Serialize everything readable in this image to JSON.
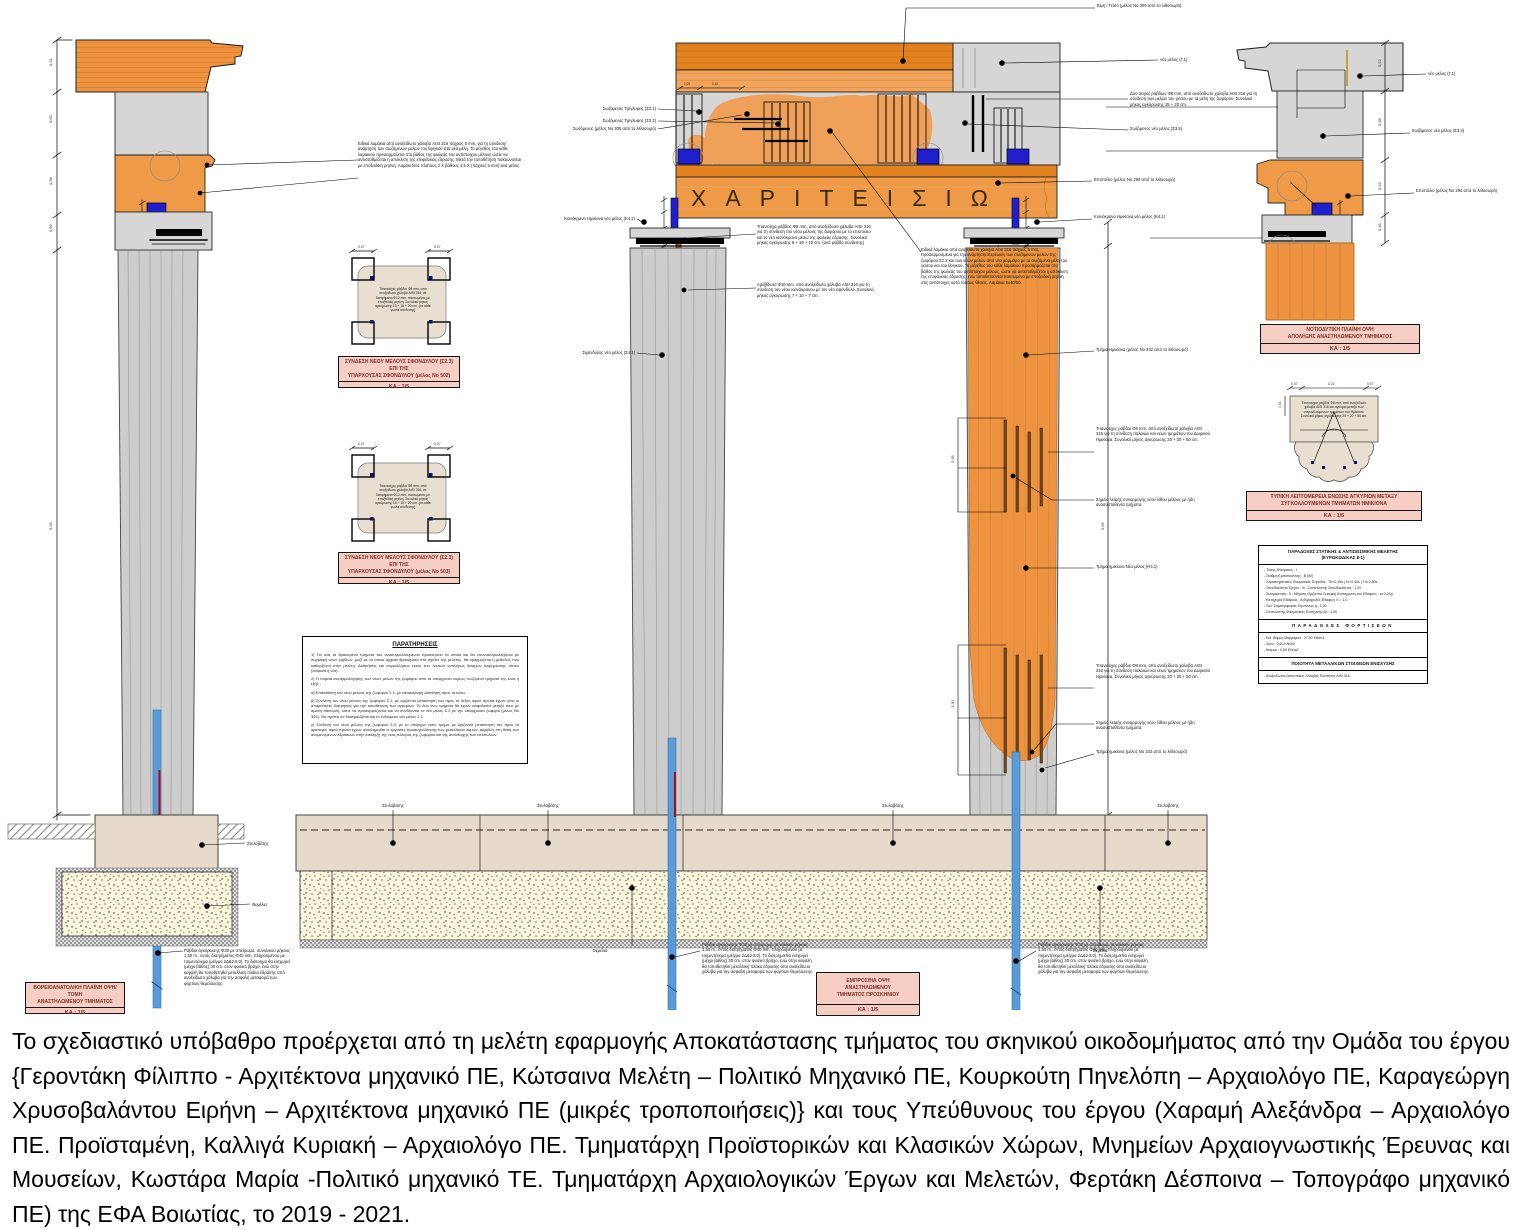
{
  "inscription": "ΧΑΡΙΤΕΙΣΙΩ",
  "label_boxes": {
    "scale": "ΚΑ : 1/5",
    "left_view": {
      "line1": "ΒΟΡΕΙΟΑΝΑΤΟΛΙΚΗ ΠΛΑΪΝΗ ΟΨΗ/ΤΟΜΗ",
      "line2": "ΑΝΑΣΤΗΛΩΜΕΝΟΥ ΤΜΗΜΑΤΟΣ"
    },
    "front_view": {
      "line1": "ΕΜΠΡΟΣΘΙΑ ΟΨΗ",
      "line2": "ΑΝΑΣΤΗΛΩΜΕΝΟΥ",
      "line3": "ΤΜΗΜΑΤΟΣ ΠΡΟΣΚΗΝΙΟΥ"
    },
    "sw_view": {
      "line1": "ΝΟΤΙΟΔΥΤΙΚΗ ΠΛΑΪΝΗ ΟΨΗ",
      "line2": "ΑΠΟΛΗΞΗΣ ΑΝΑΣΤΗΛΩΜΕΝΟΥ ΤΜΗΜΑΤΟΣ"
    },
    "detail_a": {
      "line1": "ΣΥΝΔΕΣΗ ΝΕΟΥ ΜΕΛΟΥΣ ΣΦΟΝΔΥΛΟΥ (Σ2.3) ΕΠΙ ΤΗΣ",
      "line2": "ΥΠΑΡΧΟΥΣΑΣ ΣΦΟΝΔΥΛΟΥ (μέλος Νο 502)"
    },
    "detail_b": {
      "line1": "ΣΥΝΔΕΣΗ ΝΕΟΥ ΜΕΛΟΥΣ ΣΦΟΝΔΥΛΟΥ (Σ2.3) ΕΠΙ ΤΗΣ",
      "line2": "ΥΠΑΡΧΟΥΣΑΣ ΣΦΟΝΔΥΛΟΥ (μέλος Νο 503)"
    },
    "detail_c": {
      "line1": "ΤΥΠΙΚΗ ΛΕΠΤΟΜΕΡΕΙΑ ΕΝΩΣΗΣ ΑΓΚΥΡΙΩΝ ΜΕΤΑΞΥ",
      "line2": "ΣΥΓΚΟΛΛΟΥΜΕΝΩΝ ΤΜΗΜΑΤΩΝ ΗΜΙΚΙΟΝΑ"
    }
  },
  "notes": {
    "title": "ΠΑΡΑΤΗΡΗΣΕΙΣ",
    "p1": "1) Για όλα τα θραυσμένα τμήματα του ανασυγκολλούμενου προσκηνίου τα οποία και θα επανασυγκολληθούν με συρραφή νέων ράβδων, μαζί με τα όποια αρχαία θραύσματα στα σχέδια της μελέτης, θα εφαρμόζεται η μέθοδος που καθορίζεται στην μελέτη. Διατρήσεις και συγκολλήσεις εκτός των λοιπών αναλόγως δοκιμών τεκμηρίωσης τόπου (λείψανα ή νέα).",
    "p2": "2) Η πορεία συναρμολόγησης των νέων μελών της ζωφόρου από τα υπάρχοντα κυρίως σωζόμενα τμήματά της είναι η εξής :",
    "p2a": "α) Επανάθεση του νέου μέλους της ζωφόρου Σ.1, με κατακόρυφη ολίσθηση προς τα κάτω.",
    "p2b": "β) Σύνδεση του νέου μέλους της ζωφόρου Σ.2, με οριζόντια μετακίνησή του προς τα δεξιά, αφού πρώτα έχουν γίνει οι απαραίτητες διατρήσεις για την τοποθέτηση των αγκυρίων. Τα δύο άνω τμήματα θα έχουν ασφαλιστεί μεταξύ τους με άμεση πάκτωση, ώστε να προσαρμόζονται και να συνδέονται το νέο μέλος Σ.2 με την υπάρχουσα ζωφόρο (μέλος Νο 305). Θα πρέπει να διασφαλίζεται και το ενδιάμεσο νέο μέλος Σ.1.",
    "p2c": "γ) Σύνδεση του νέου μέλους της ζωφόρου Σ.3, με το υπάρχον νότιο τμήμα, με οριζόντια μετακίνησή του προς τα αριστερά, αφού πρώτα έχουν ολοκληρωθεί οι εργασίες προσυγκόλλησης των μεταλλικών λαμών, ακριβώς στη θέση των αναμενόμενων εδράσεων στην απόληξη της νέας πλευράς της ζωφόρου και της αντίστοιχης των επιστυλίων."
  },
  "spec": {
    "title1": "ΠΑΡΑΔΟΧΕΣ ΣΤΑΤΙΚΗΣ & ΑΝΤΙΣΕΙΣΜΙΚΗΣ ΜΕΛΕΤΗΣ",
    "title2": "(ΕΥΡΩΚΩΔΙΚΑΣ 8-1)",
    "items1": [
      "- Τύπος Φάσματος : Ι",
      "- Στάθμη Εμπιστοσύνης : Β (50)",
      "- Χαρακτηριστικές Φασματικές Περίοδοι : Tb=0,15s | Tc=0,40s | Td=2,50s",
      "- Σπουδαιότητα Έργου : ΙΙΙ - Συντελεστής Σπουδαιότητας : 1,20",
      "- Σεισμικότητα : ΙΙ - Μέγιστη Οριζόντια Σεισμική Επιτάχυνση του Εδάφους : a=0,24g",
      "- Κατηγορία Εδάφους : Α (Βραχώδες Έδαφος) S = 1,0",
      "- Συν. Συμπεριφοράς Τυμπάνων q : 1,00",
      "- Συντελεστής Φασματικής Ενίσχυσης βο : 2,50"
    ],
    "title3": "ΠΑΡΑΔΟΧΕΣ ΦΟΡΤΙΣΕΩΝ",
    "items2": [
      "- Ειδ. Βάρος Μαρμάρου : 27,00 KN/m3",
      "- Χιόνι : 0,60 KN/m2",
      "- Άνεμος : 0,50 KN/m2"
    ],
    "title4": "ΠΟΙΟΤΗΤΑ ΜΕΤΑΛΛΙΚΩΝ ΣΤΟΙΧΕΙΩΝ ΕΝΙΣΧΥΣΗΣ",
    "items3": [
      "- Ανοξείδωτος Ωστενιτικός Χάλυβας Ποιότητας AISI 316"
    ]
  },
  "callouts": {
    "styl": "Στυλοβάτης",
    "them": "Θεμέλια",
    "anchor_note": "Ράβδοι αγκύρωσης Φ30 με σπείρωμα, συνολικού μήκους 1,50 m., εντός διατρήματος Φ40 mm, πληρούμενου με τσιμεντένεμα (μείγμα 2Δ&2.5.0). Το διάτρημα θα εισχωρεί (μέχρι βάθος) 30 cm. στον φυσικό βράχο, ενώ στην κεφαλή θα τοποθετηθεί μεταλλική πλάκα έδρασης από ανοξείδωτο χάλυβα για την ασφαλή μεταφορά των φορτίων θεμελίωσης.",
    "trig1": "Σωζόμενος Τρίγλυφος (Σ3.1)",
    "trig2": "Σωζόμενος Τρίγλυφος (Σ3.3)",
    "member305": "Σωζόμενος (μέλος Νο 305 από το λιθοσωρό)",
    "cap_left": "Κιονόκρανο Ημικίονα νέο μέλος (Κ4.2)",
    "sph_left": "Σφόνδυλος νέο μέλος (Σ4.1)",
    "rod_a": "Τιτανιούχα ράβδος Φ8 mm, από ανοξείδωτο χάλυβα AISI 316 για τη σύνδεση του νέου μέλους της ζωφόρου με το επιστύλιο και το νέο κιονόκρανο μέσω της φωλεάς έδρασης. Συνολικό μήκος αγκύρωσης 6 + 10 + 10 cm. (ανά ράβδο σύνδεσης)",
    "rod_b": "Αράβδωτο Φ10 mm, από ανοξείδωτο χάλυβα AISI 316 για τη σύνδεση του νέου κιονόκρανου με τον νέο σφόνδυλο. Συνολικό μήκος αγκύρωσης 7 + 10 + 7 cm.",
    "lam_note": "Ειδικά λαμάκια από ανοξείδωτο χάλυβα AISI 316 πάχους 5 mm, προσαρμοσμένα για την ανάρτηση/στερέωση των σωζόμενων μελών της ζωφόρου Σ2.3 και των νέων μελών από νέο μάρμαρο με τα σωζόμενα μέλη του γείσου και του θριγκού. Το μέγεθος του κάθε λαμακιού προσαρμόζεται στο βάθος της φωλεάς του αντίστοιχου μέλους, ώστε να αντισταθμίζεται η απόκλιση της επιφάνειας έδρασης, ενώ τοποθετούνται πακτωμένα με εποξειδική ρητίνη στις αντίστοιχες κατά τόπους θέσεις. Λαμάκια 5x40/50.",
    "lam_left": "Ειδικά λαμάκια από ανοξείδωτο χάλυβα AISI 316 πάχους 5 mm, για τη σύνδεση/ανάρτηση των σωζόμενων μελών του θριγκού στα νέα μέλη. Το μέγεθος του κάθε λαμακιού προσαρμόζεται στο βάθος της φωλεάς του αντίστοιχου μέλους ώστε να αντισταθμίζεται η απόκλιση της επιφάνειας έδρασης. Μετά την τοποθέτηση πακτώνονται με εποξειδική ρητίνη. Λαμάκι Νο1 πλάτους 2 Χ βάθους 1,5 Χ (πάχους 5 mm) ανά μέλος.",
    "geiso_top": "Σίμη / Γείσο (μέλος Νο 300 από το λιθοσωρό)",
    "neo_g1": "νέο μέλος (Γ.1)",
    "two_rows": "Δύο σειρές ράβδων Φ8 mm, από ανοξείδωτο χάλυβα AISI 316 για τη σύνδεση των μελών του γείσου με τα μέλη της ζωφόρου. Συνολικό μήκος αγκύρωσης 15 + 20 cm.",
    "trig5": "Σωζόμενος νέο μέλος (Σ3.5)",
    "soz_s33": "Σωζόμενος νέο μέλος (Σ3.3)",
    "epistyle": "Επιστύλιο (μέλος Νο 294 από το λιθοσωρό)",
    "cap_right": "Κιονόκρανο Ημικίονα νέο μέλος (Κ4.1)",
    "hemi_342": "Τμήμα Ημικίονα (μέλος Νο 342 από το λιθοσωρό)",
    "tit_rods": "Τιτανιούχες ράβδοι Φ8 mm, από ανοξείδωτο χάλυβα AISI 316 για τη σύνδεση παλαιών και νέων τμημάτων του Δωρικού Ημικίονα. Συνολικό μήκος αγκύρωσης 20 + 20 + 50 cm.",
    "seam": "Σημείο λειψής συναρμογής νέου λίθου μέλους με ήδη ανασυσταθέντα τμήματα.",
    "hemi_new": "Τμήμα ημικίονα Νέο μέλος (Η4.1)",
    "hemi_343": "Τμήμα ημικίονα (μέλος Νο 343 από το λιθοσωρό)"
  },
  "details": {
    "detail_ab_note": "Τιτανιούχες ράβδοι Φ8 mm, από ανοξείδωτο χάλυβα AISI 316, σε διατρήματα Φ12 mm, πακτωμένες με εποξειδική ρητίνη. Συνολικό μήκος αγκύρωσης 15 + 15 + 20 cm. (σε κάθε γωνία σύνδεσης)",
    "detail_c_note": "Τιτανιούχες ράβδοι Φ8 mm, από ανοξείδωτο χάλυβα AISI 316 και αγκύρια μεταξύ των συγκολλούμενων τμημάτων του Ημικίονα. Συνολικό μήκος αγκύρωσης 20 + 20 + 50 cm."
  },
  "dims": {
    "v1": "0,51",
    "v2": "0,63",
    "v3": "0,58",
    "v4": "0,60",
    "v5": "5,65",
    "h05": "0,05",
    "h15": "0,15",
    "h07": "0,07",
    "h20": "0,20",
    "v51b": "0,51",
    "v52": "0,52",
    "v68": "0,68",
    "v54": "0,54",
    "v45": "0,45",
    "c1": "0,95",
    "c2": "1,30"
  },
  "footer": "Το σχεδιαστικό υπόβαθρο προέρχεται από τη μελέτη εφαρμογής Αποκατάστασης τμήματος του σκηνικού οικοδομήματος από την Ομάδα του έργου {Γεροντάκη Φίλιππο - Αρχιτέκτονα μηχανικό ΠΕ, Κώτσαινα Μελέτη – Πολιτικό Μηχανικό ΠΕ, Κουρκούτη Πηνελόπη – Αρχαιολόγο ΠΕ, Καραγεώργη Χρυσοβαλάντου Ειρήνη – Αρχιτέκτονα μηχανικό ΠΕ (μικρές τροποποιήσεις)} και τους Υπεύθυνους του έργου (Χαραμή Αλεξάνδρα – Αρχαιολόγο ΠΕ. Προϊσταμένη, Καλλιγά Κυριακή – Αρχαιολόγο ΠΕ. Τμηματάρχη Προϊστορικών και Κλασικών Χώρων, Μνημείων Αρχαιογνωστικής Έρευνας και Μουσείων, Κωστάρα Μαρία -Πολιτικό μηχανικό ΤΕ. Τμηματάρχη Αρχαιολογικών Έργων και Μελετών, Φερτάκη Δέσποινα – Τοπογράφο μηχανικό ΠΕ) της ΕΦΑ Βοιωτίας, το 2019 - 2021."
}
